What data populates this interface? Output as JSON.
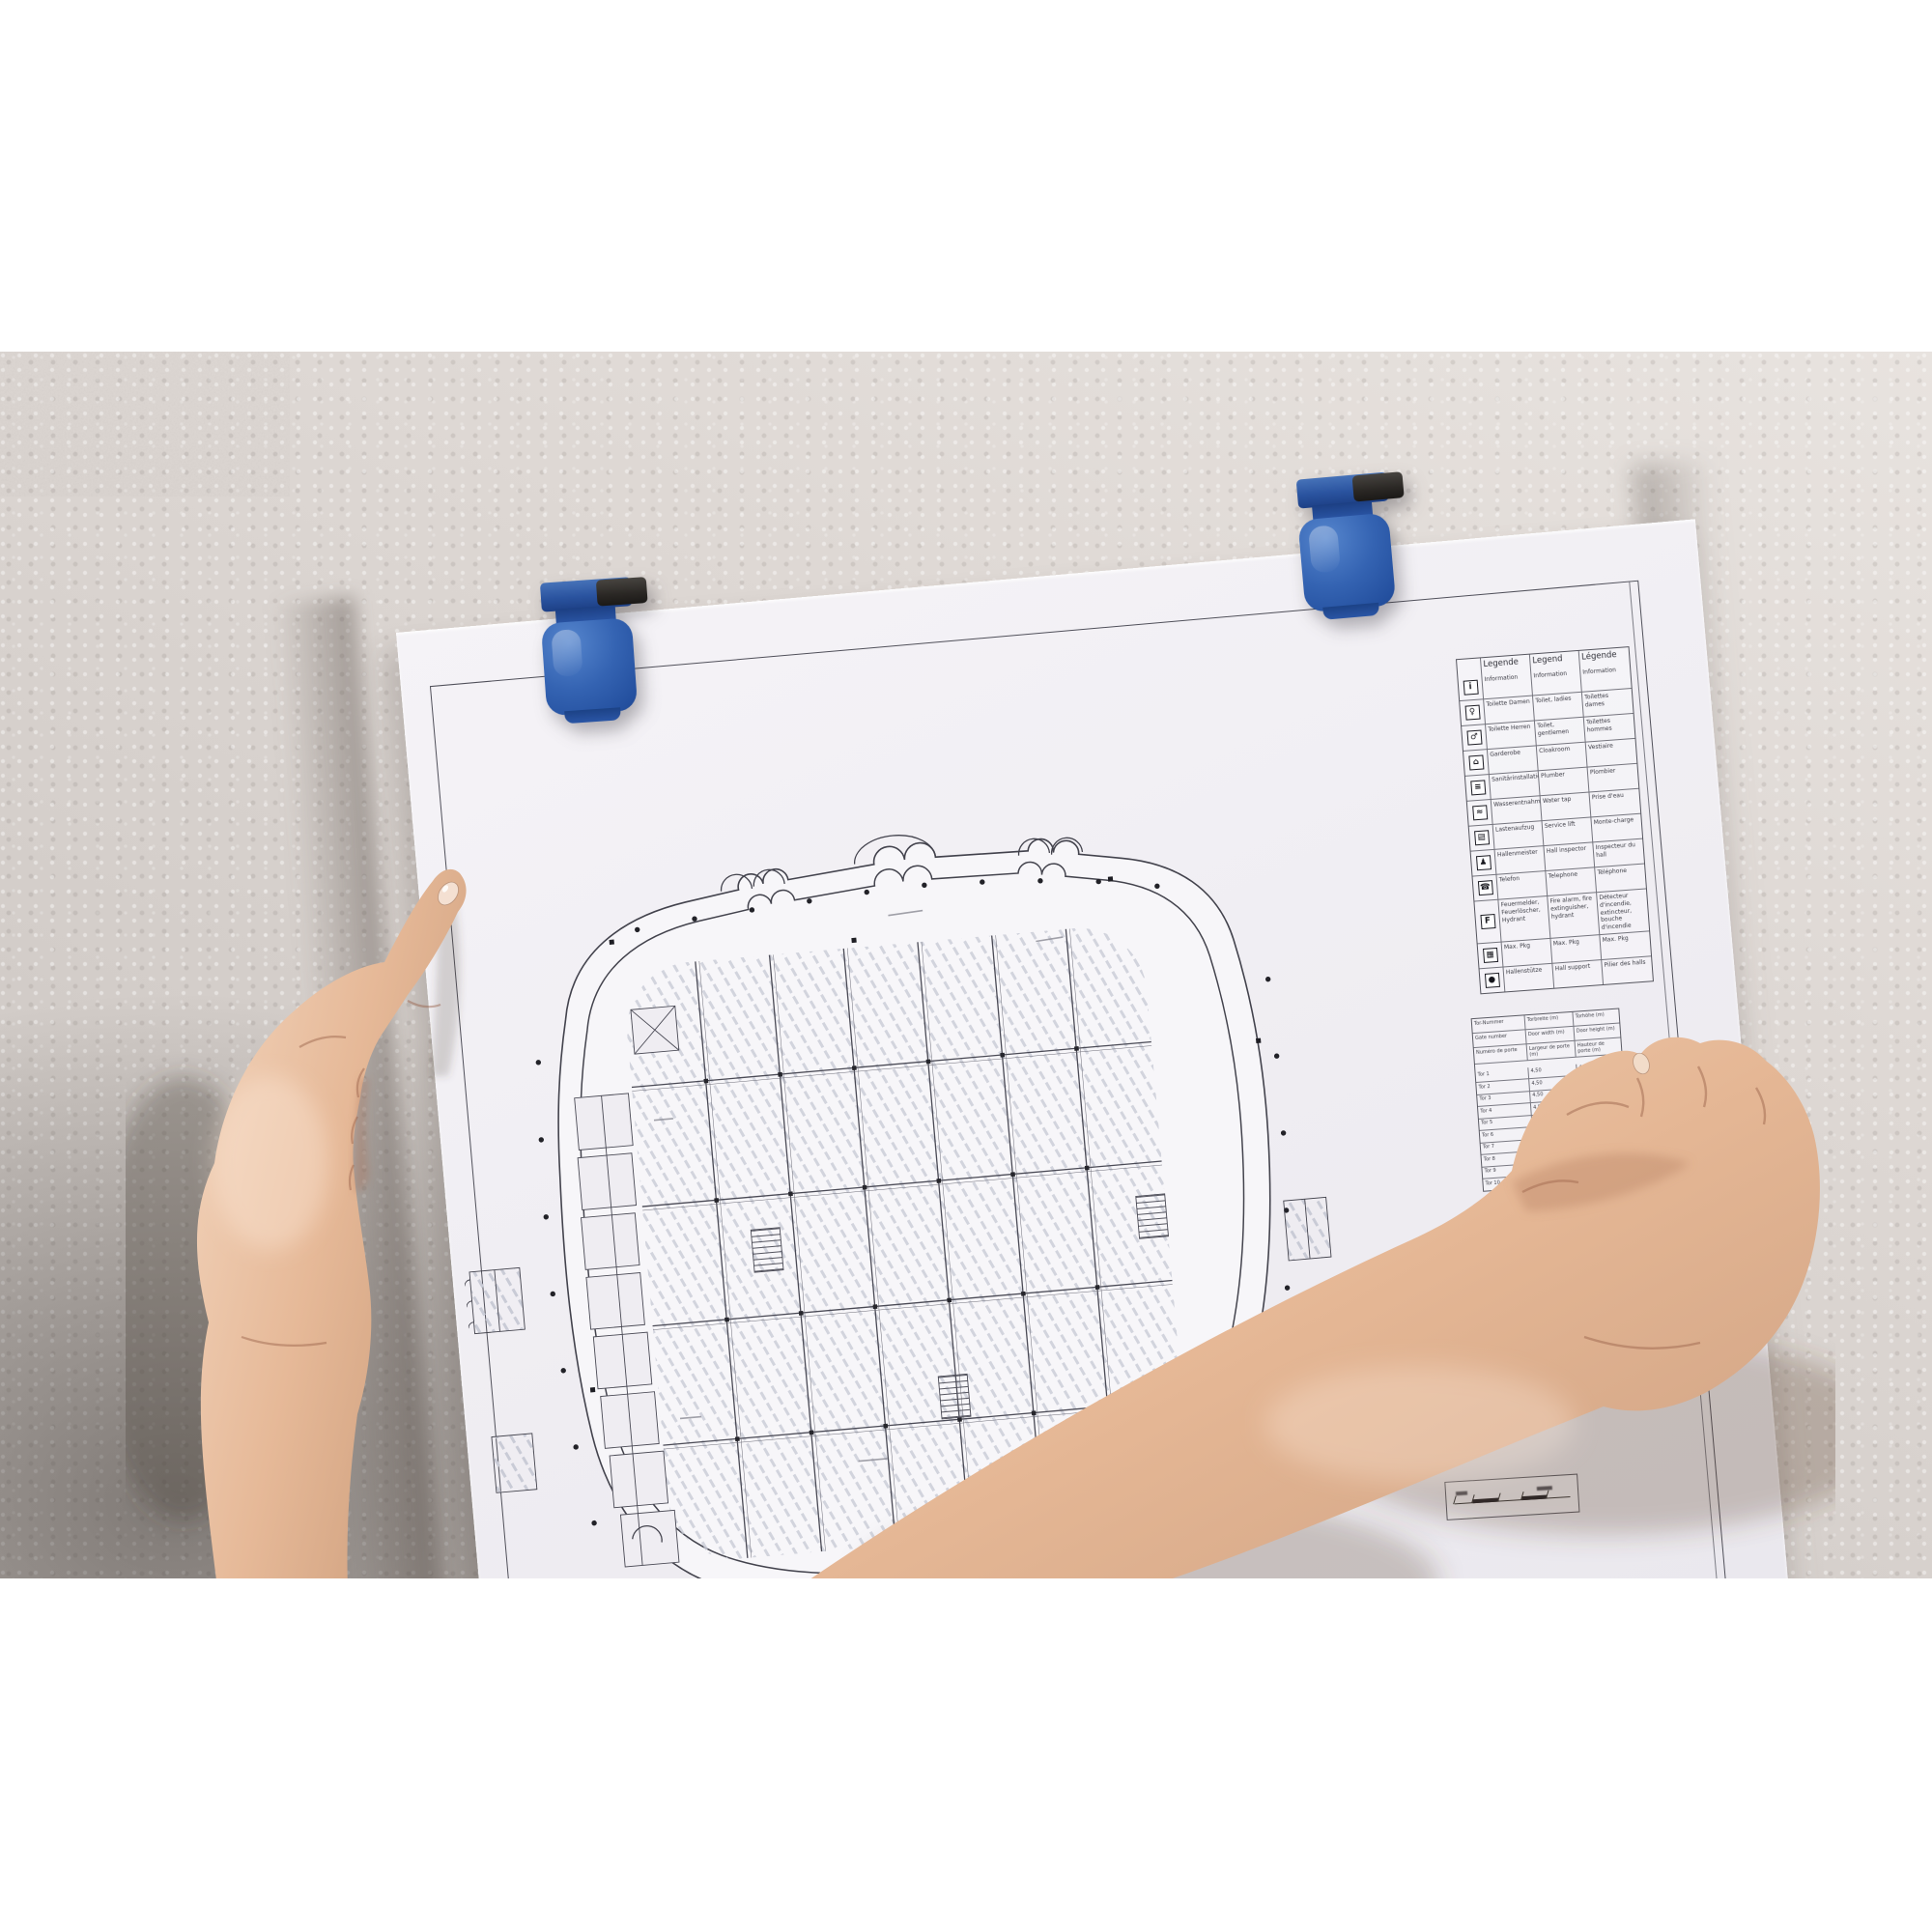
{
  "legend": {
    "headers": {
      "de": "Legende",
      "en": "Legend",
      "fr": "Légende"
    },
    "rows": [
      {
        "icon": "information-icon",
        "glyph": "i",
        "de": "Information",
        "en": "Information",
        "fr": "Information"
      },
      {
        "icon": "toilet-ladies-icon",
        "glyph": "♀",
        "de": "Toilette Damen",
        "en": "Toilet, ladies",
        "fr": "Toilettes dames"
      },
      {
        "icon": "toilet-gents-icon",
        "glyph": "♂",
        "de": "Toilette Herren",
        "en": "Toilet, gentlemen",
        "fr": "Toilettes hommes"
      },
      {
        "icon": "cloakroom-icon",
        "glyph": "⌂",
        "de": "Garderobe",
        "en": "Cloakroom",
        "fr": "Vestiaire"
      },
      {
        "icon": "plumber-icon",
        "glyph": "≡",
        "de": "Sanitärinstallation",
        "en": "Plumber",
        "fr": "Plombier"
      },
      {
        "icon": "water-tap-icon",
        "glyph": "≈",
        "de": "Wasserentnahme",
        "en": "Water tap",
        "fr": "Prise d'eau"
      },
      {
        "icon": "service-lift-icon",
        "glyph": "▤",
        "de": "Lastenaufzug",
        "en": "Service lift",
        "fr": "Monte-charge"
      },
      {
        "icon": "hall-inspector-icon",
        "glyph": "♟",
        "de": "Hallenmeister",
        "en": "Hall inspector",
        "fr": "Inspecteur du hall"
      },
      {
        "icon": "telephone-icon",
        "glyph": "☎",
        "de": "Telefon",
        "en": "Telephone",
        "fr": "Téléphone"
      },
      {
        "icon": "fire-equipment-icon",
        "glyph": "F",
        "de": "Feuermelder, Feuerlöscher, Hydrant",
        "en": "Fire alarm, fire extinguisher, hydrant",
        "fr": "Détecteur d'incendie, extincteur, bouche d'incendie"
      },
      {
        "icon": "max-load-icon",
        "glyph": "▦",
        "de": "Max. Pkg",
        "en": "Max. Pkg",
        "fr": "Max. Pkg"
      },
      {
        "icon": "hall-support-icon",
        "glyph": "●",
        "de": "Hallenstütze",
        "en": "Hall support",
        "fr": "Pilier des halls"
      }
    ]
  },
  "gate_table": {
    "header_rows": [
      {
        "c1": "Tor-Nummer",
        "c2": "Torbreite (m)",
        "c3": "Torhöhe (m)"
      },
      {
        "c1": "Gate number",
        "c2": "Door width (m)",
        "c3": "Door height (m)"
      },
      {
        "c1": "Numéro de porte",
        "c2": "Largeur de porte (m)",
        "c3": "Hauteur de porte (m)"
      }
    ],
    "rows": [
      {
        "c1": "Tor 1",
        "c2": "4,50",
        "c3": "4,50"
      },
      {
        "c1": "Tor 2",
        "c2": "4,50",
        "c3": "4,50"
      },
      {
        "c1": "Tor 3",
        "c2": "4,50",
        "c3": "4,50"
      },
      {
        "c1": "Tor 4",
        "c2": "4,50",
        "c3": "4,50"
      },
      {
        "c1": "Tor 5",
        "c2": "4,50",
        "c3": "4,50"
      },
      {
        "c1": "Tor 6",
        "c2": "4,50",
        "c3": "4,50"
      },
      {
        "c1": "Tor 7",
        "c2": "4,50",
        "c3": "4,50"
      },
      {
        "c1": "Tor 8",
        "c2": "4,50",
        "c3": "4,50"
      },
      {
        "c1": "Tor 9",
        "c2": "4,50",
        "c3": "4,50"
      },
      {
        "c1": "Tor 10",
        "c2": "4,50",
        "c3": "4,50"
      }
    ]
  },
  "colors": {
    "clip_blue": "#2b56a7",
    "clip_blue_dark": "#173a7c",
    "clip_lever_black": "#2a2724",
    "wall": "#d8d2ce",
    "paper": "#f1eff3",
    "plan_ink": "#43434d"
  }
}
